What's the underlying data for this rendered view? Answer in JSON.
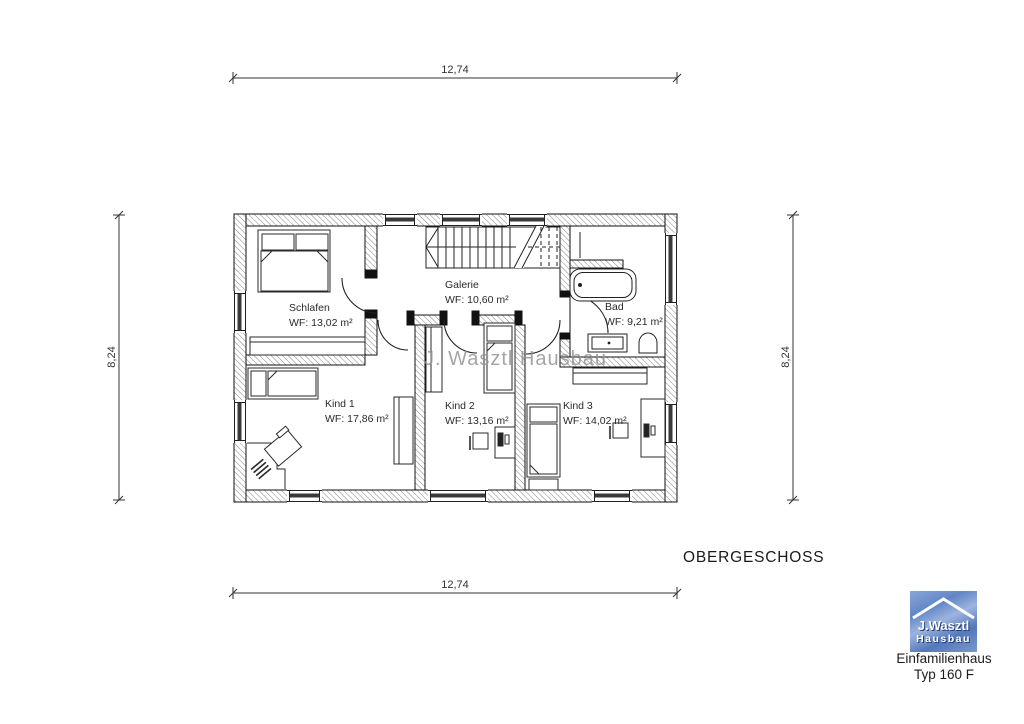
{
  "floor_plan": {
    "title": "OBERGESCHOSS",
    "watermark": "J. Wasztl Hausbau",
    "dimensions": {
      "top": "12,74",
      "bottom": "12,74",
      "left": "8,24",
      "right": "8,24"
    },
    "rooms": [
      {
        "name": "Schlafen",
        "area": "WF: 13,02 m²"
      },
      {
        "name": "Galerie",
        "area": "WF: 10,60 m²"
      },
      {
        "name": "Bad",
        "area": "WF: 9,21 m²"
      },
      {
        "name": "Kind 1",
        "area": "WF: 17,86 m²"
      },
      {
        "name": "Kind 2",
        "area": "WF: 13,16 m²"
      },
      {
        "name": "Kind 3",
        "area": "WF: 14,02 m²"
      }
    ]
  },
  "branding": {
    "logo_line1": "J.Wasztl",
    "logo_line2": "Hausbau",
    "caption_line1": "Einfamilienhaus",
    "caption_line2": "Typ 160 F"
  },
  "colors": {
    "line": "#222222",
    "wall_hatch": "#777777",
    "logo_blue": "#5b7fc0",
    "watermark_gray": "#8f8f8f"
  }
}
